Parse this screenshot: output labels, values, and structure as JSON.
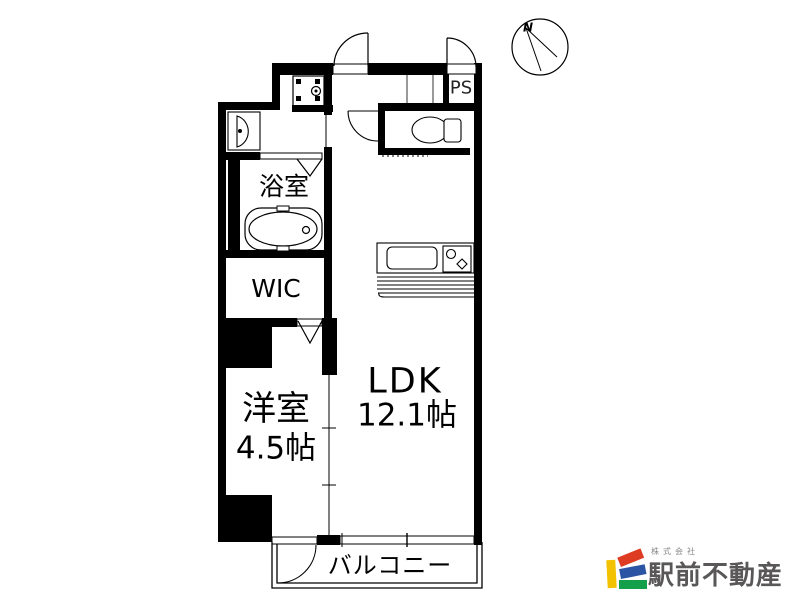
{
  "floor_plan": {
    "compass_label": "N",
    "rooms": {
      "bath": {
        "label": "浴室"
      },
      "wic": {
        "label": "WIC"
      },
      "western_room": {
        "name": "洋室",
        "size": "4.5帖"
      },
      "ldk": {
        "name": "LDK",
        "size": "12.1帖"
      },
      "balcony": {
        "label": "バルコニー"
      },
      "pipe_space": {
        "label": "PS"
      }
    },
    "fixtures": [
      "washing-machine-pan",
      "washbasin",
      "bathtub",
      "toilet",
      "kitchen-counter-with-sink-and-stove"
    ],
    "colors": {
      "walls": "#000000",
      "background": "#ffffff"
    }
  },
  "branding": {
    "company_prefix": "株式会社",
    "company_name": "駅前不動産",
    "logo_colors": {
      "yellow": "#f2c200",
      "red": "#dd3b22",
      "blue": "#2b55a4",
      "green": "#14a04a",
      "name_text": "#595757",
      "prefix_text": "#8a8888"
    }
  }
}
